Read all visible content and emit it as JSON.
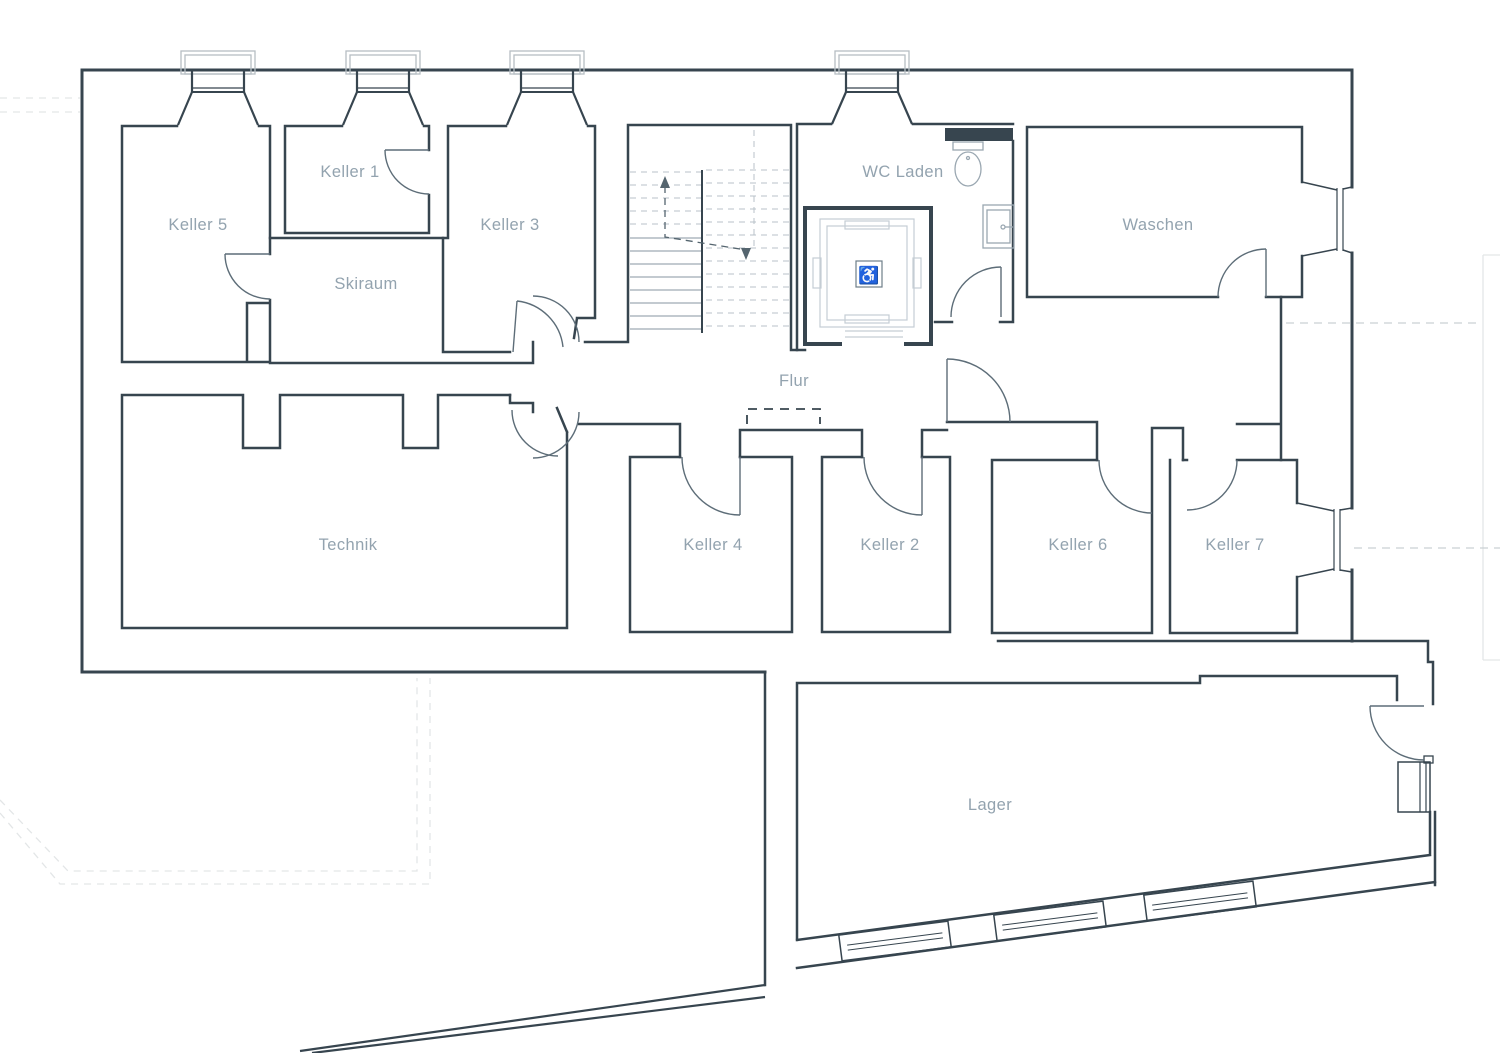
{
  "plan": {
    "kind": "basement floor plan drawing",
    "colors": {
      "wall": "#37454f",
      "door_swing": "#5d6d78",
      "room_label": "#93a3af",
      "fixture_light": "#c5cdd4",
      "fixture_mid": "#9aa7b1",
      "stair_tread": "#8795a0",
      "dashed_faint": "#e3e6e7",
      "dashed_mid": "#c9d0d4",
      "background": "#ffffff"
    },
    "rooms": [
      {
        "id": "keller-5",
        "label": "Keller 5"
      },
      {
        "id": "keller-1",
        "label": "Keller 1"
      },
      {
        "id": "keller-3",
        "label": "Keller 3"
      },
      {
        "id": "skiraum",
        "label": "Skiraum"
      },
      {
        "id": "wc-laden",
        "label": "WC Laden"
      },
      {
        "id": "waschen",
        "label": "Waschen"
      },
      {
        "id": "flur",
        "label": "Flur"
      },
      {
        "id": "technik",
        "label": "Technik"
      },
      {
        "id": "keller-4",
        "label": "Keller 4"
      },
      {
        "id": "keller-2",
        "label": "Keller 2"
      },
      {
        "id": "keller-6",
        "label": "Keller 6"
      },
      {
        "id": "keller-7",
        "label": "Keller 7"
      },
      {
        "id": "lager",
        "label": "Lager"
      }
    ],
    "fixtures": {
      "wheelchair_glyph": "♿"
    }
  }
}
